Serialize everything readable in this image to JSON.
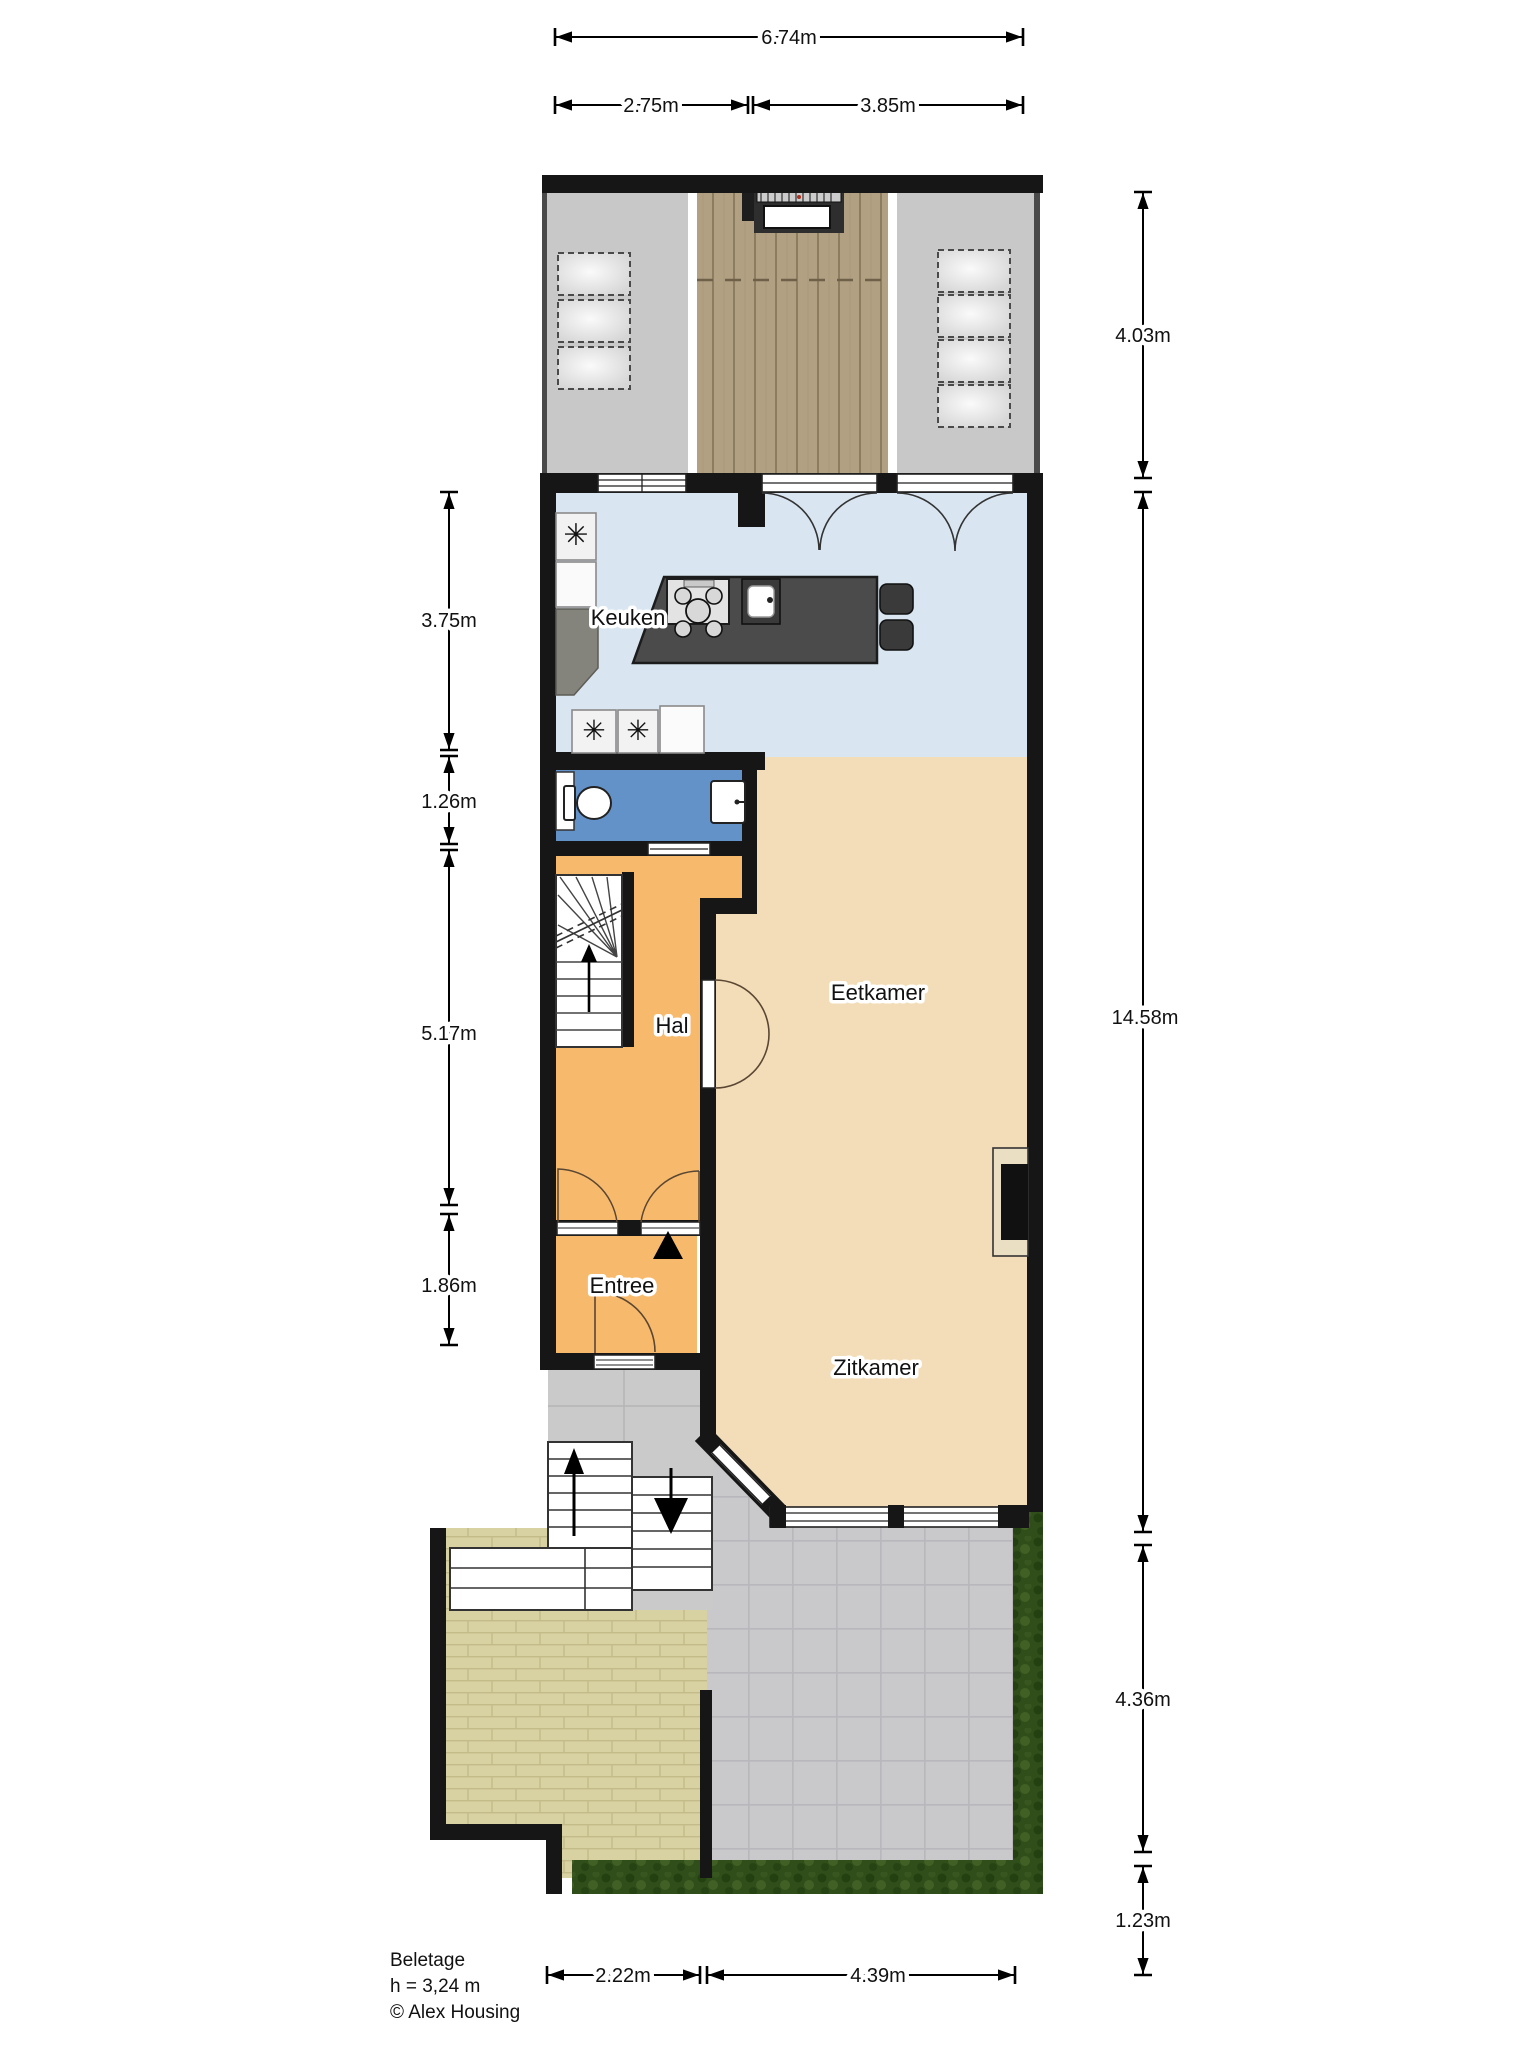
{
  "plan": {
    "rooms": {
      "kitchen": "Keuken",
      "hall": "Hal",
      "dining": "Eetkamer",
      "entry": "Entree",
      "living": "Zitkamer"
    },
    "dimensions": {
      "top_total": "6.74m",
      "top_left": "2.75m",
      "top_right": "3.85m",
      "right_terrace": "4.03m",
      "right_house": "14.58m",
      "right_garden": "4.36m",
      "right_hedge": "1.23m",
      "left_kitchen": "3.75m",
      "left_toilet": "1.26m",
      "left_hall": "5.17m",
      "left_entry": "1.86m",
      "bottom_left": "2.22m",
      "bottom_right": "4.39m"
    },
    "footer": {
      "floor_name": "Beletage",
      "ceiling_height": "h = 3,24 m",
      "copyright": "© Alex Housing"
    },
    "colors": {
      "wall": "#161616",
      "kitchenFloor": "#d9e6f2",
      "toiletFloor": "#6392c8",
      "hallFloor": "#f7ba6c",
      "livingFloor": "#f3ddb8",
      "roofGray": "#c8c8c8",
      "deckWood": "#b2a083",
      "brickPath": "#d8d1a2",
      "terraceTile": "#c9c9cb",
      "hedgeGreen": "#2f4e1a",
      "islandDark": "#4b4b4b"
    }
  }
}
